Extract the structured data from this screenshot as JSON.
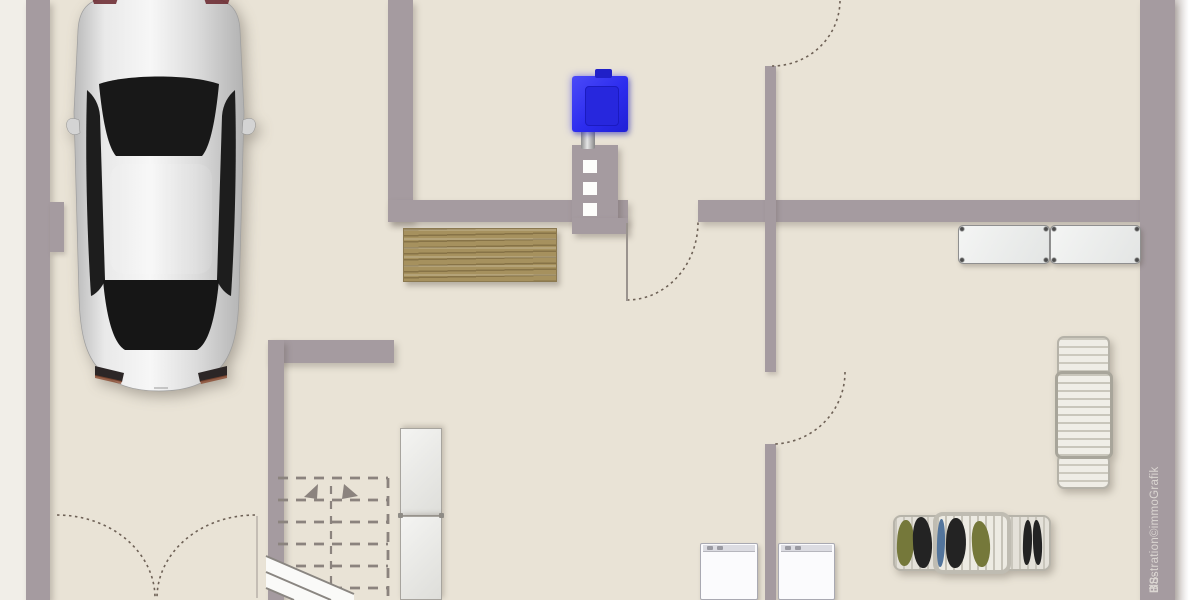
{
  "credit": {
    "prefix": "BS-",
    "text": "Illustration©immoGrafik"
  },
  "colors": {
    "wall": "#a59ba0",
    "floor": "#e9e3d6",
    "exterior_left": "#f1eee8",
    "exterior_right": "#ffffff",
    "boiler_blue": "#2c2cee",
    "wood": "#a6915e",
    "glass_dark": "#171717",
    "car_silver": "#e3e3e3",
    "door_swing_dash": "#6e6156",
    "stair_dash": "#8b837e",
    "white_goods": "#fbfbfd",
    "rack_gray": "#e8e6df",
    "clothes_olive": "#75783a",
    "clothes_black": "#232323",
    "clothes_blue": "#53759c"
  },
  "objects": {
    "plan": "basement-floor-plan-illustration",
    "car": "car-top-view",
    "boiler": "heating-boiler",
    "chimney": "chimney-with-vents",
    "workbench": "wooden-workbench",
    "sofa": "bench-sofa",
    "cabinet": "tall-cabinet",
    "stairs": "staircase-up-dashed",
    "washer_left": "washing-machine",
    "washer_right": "washing-machine",
    "rack_empty": "drying-rack",
    "rack_clothes": "drying-rack-with-laundry",
    "garage_door": "double-swing-garage-door",
    "credit": "illustration-credit"
  }
}
